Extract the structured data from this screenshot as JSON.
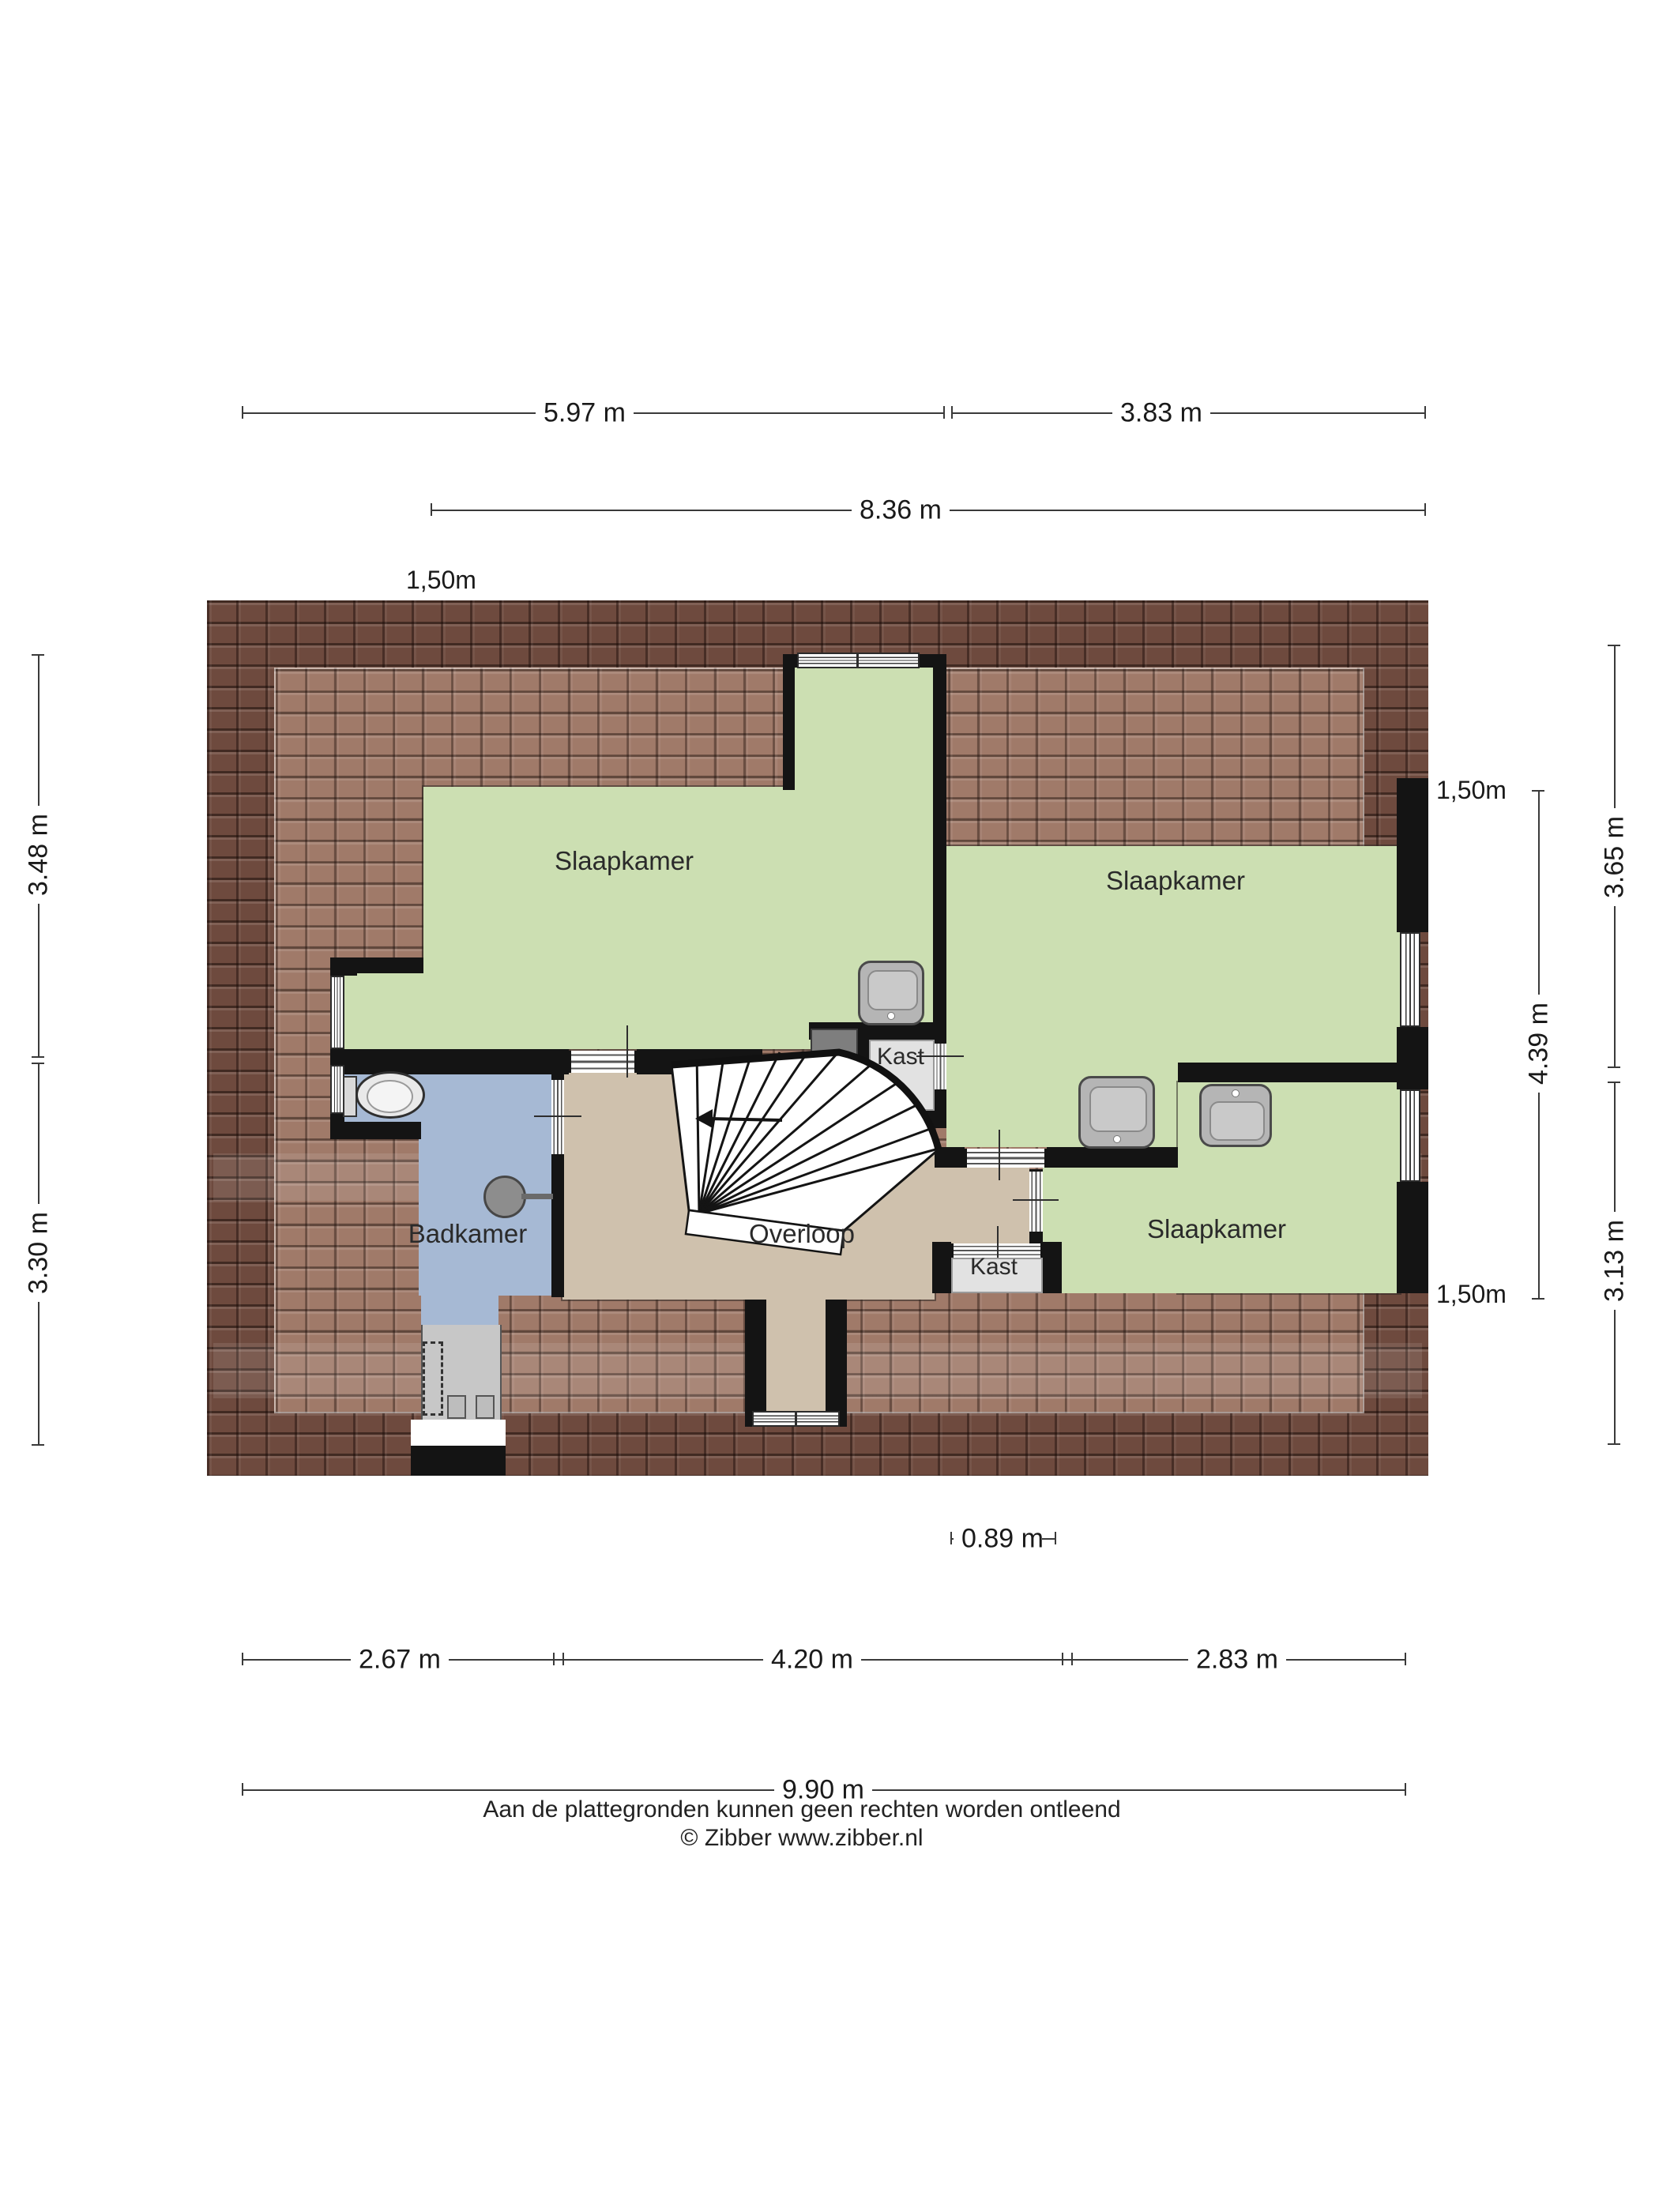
{
  "plan": {
    "rooms": {
      "bedroom_left": "Slaapkamer",
      "bedroom_right": "Slaapkamer",
      "bedroom_bottom": "Slaapkamer",
      "bathroom": "Badkamer",
      "landing": "Overloop",
      "closet_top": "Kast",
      "closet_bottom": "Kast"
    },
    "fixtures": {
      "toilet": "toilet-icon",
      "sink": "sink-icon",
      "shower": "shower-icon",
      "stairs": "winder-stairs-icon"
    }
  },
  "dimensions": {
    "top_left": "5.97 m",
    "top_right": "3.83 m",
    "top_total": "8.36 m",
    "attic_line_top_left": "1,50m",
    "attic_line_top_right": "1,50m",
    "attic_line_bottom_right": "1,50m",
    "left_upper": "3.48 m",
    "left_lower": "3.30 m",
    "right_inner": "4.39 m",
    "right_upper": "3.65 m",
    "right_lower": "3.13 m",
    "window_width": "0.89 m",
    "bottom_left": "2.67 m",
    "bottom_mid": "4.20 m",
    "bottom_right": "2.83 m",
    "bottom_total": "9.90 m"
  },
  "footer": {
    "disclaimer": "Aan de plattegronden kunnen geen rechten worden ontleend",
    "copyright": "© Zibber www.zibber.nl"
  },
  "colors": {
    "room_green": "#ccdfb2",
    "room_blue": "#a6b9d4",
    "room_tan": "#cfc1ad",
    "closet_grey": "#e2e2e2",
    "roof_dark": "#6e4a3e",
    "roof_light": "#a07a69",
    "wall_black": "#141414"
  }
}
